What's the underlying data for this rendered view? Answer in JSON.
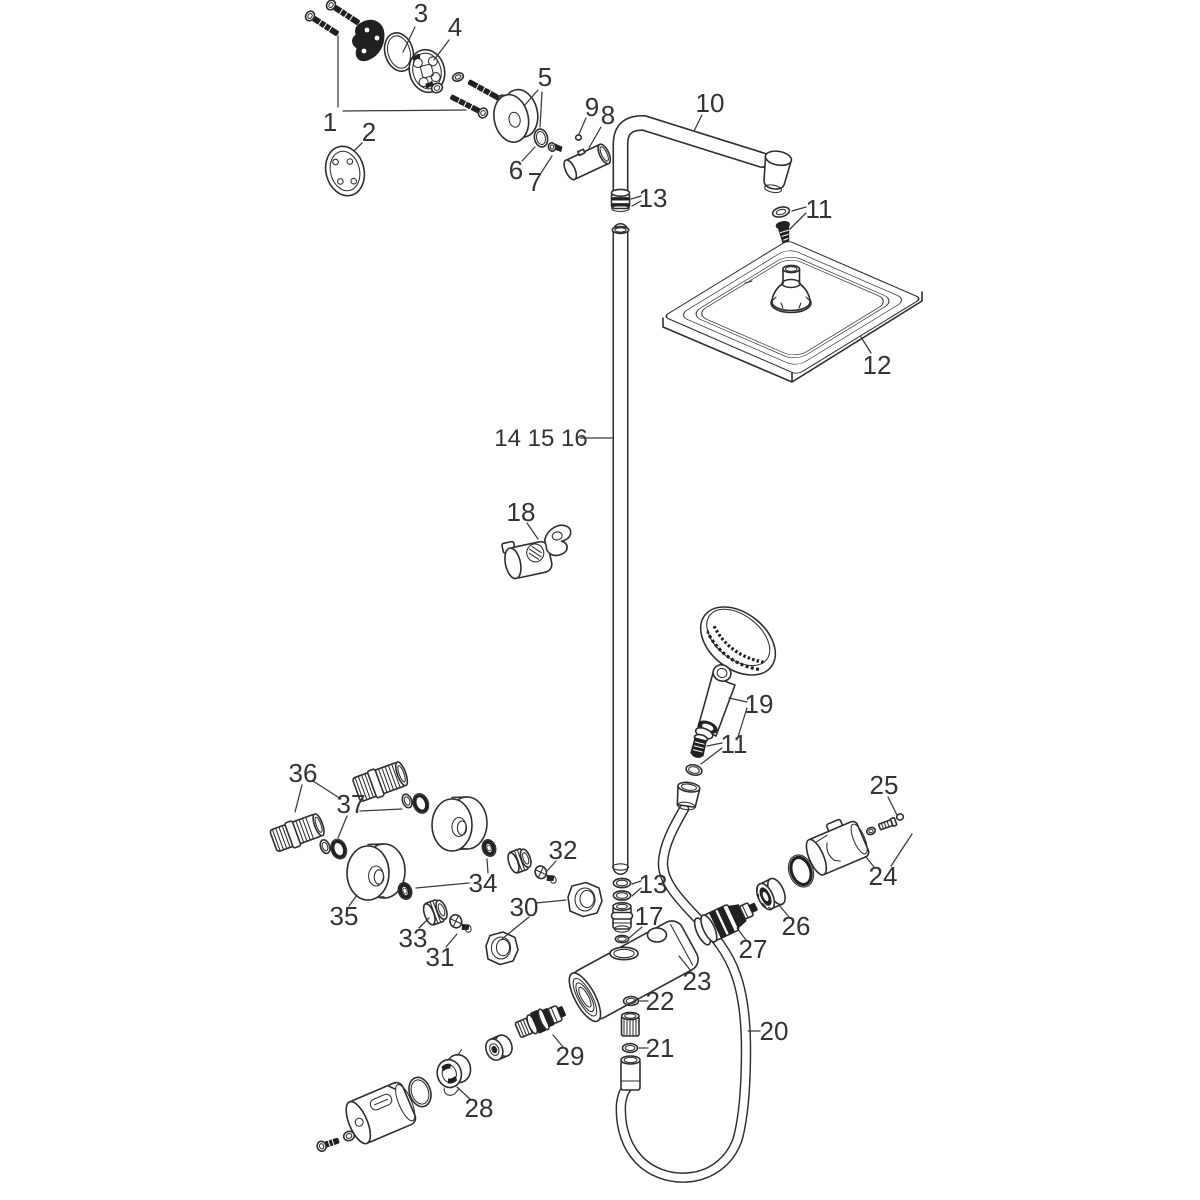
{
  "diagram": {
    "background": "#ffffff",
    "line_color": "#2e2e2e",
    "label_color": "#333333",
    "label_font_size": 26
  },
  "labels": [
    {
      "id": "3",
      "text": "3",
      "x": 421,
      "y": 22,
      "leaders": [
        [
          [
            415,
            27
          ],
          [
            403,
            52
          ]
        ]
      ]
    },
    {
      "id": "4",
      "text": "4",
      "x": 455,
      "y": 36,
      "leaders": [
        [
          [
            449,
            40
          ],
          [
            434,
            60
          ]
        ]
      ]
    },
    {
      "id": "1",
      "text": "1",
      "x": 330,
      "y": 131,
      "leaders": [
        [
          [
            338,
            107
          ],
          [
            338,
            36
          ]
        ],
        [
          [
            343,
            111
          ],
          [
            466,
            110
          ]
        ]
      ]
    },
    {
      "id": "2",
      "text": "2",
      "x": 369,
      "y": 141,
      "leaders": [
        [
          [
            362,
            143
          ],
          [
            354,
            151
          ]
        ]
      ]
    },
    {
      "id": "5",
      "text": "5",
      "x": 545,
      "y": 86,
      "leaders": [
        [
          [
            538,
            90
          ],
          [
            524,
            106
          ]
        ],
        [
          [
            542,
            92
          ],
          [
            540,
            127
          ]
        ]
      ]
    },
    {
      "id": "6",
      "text": "6",
      "x": 516,
      "y": 179,
      "leaders": [
        [
          [
            522,
            161
          ],
          [
            535,
            147
          ]
        ]
      ]
    },
    {
      "id": "7",
      "text": "7",
      "x": 535,
      "y": 191,
      "leaders": [
        [
          [
            541,
            173
          ],
          [
            552,
            156
          ]
        ]
      ]
    },
    {
      "id": "8",
      "text": "8",
      "x": 608,
      "y": 124,
      "leaders": [
        [
          [
            601,
            127
          ],
          [
            589,
            148
          ]
        ]
      ]
    },
    {
      "id": "9",
      "text": "9",
      "x": 592,
      "y": 116,
      "leaders": [
        [
          [
            586,
            118
          ],
          [
            579,
            134
          ]
        ]
      ]
    },
    {
      "id": "10",
      "text": "10",
      "x": 710,
      "y": 112,
      "leaders": [
        [
          [
            702,
            115
          ],
          [
            694,
            131
          ]
        ]
      ]
    },
    {
      "id": "11-top",
      "text": "11",
      "x": 819,
      "y": 218,
      "leaders": [
        [
          [
            806,
            207
          ],
          [
            792,
            211
          ]
        ],
        [
          [
            806,
            213
          ],
          [
            790,
            229
          ]
        ]
      ]
    },
    {
      "id": "12",
      "text": "12",
      "x": 877,
      "y": 374,
      "leaders": [
        [
          [
            871,
            353
          ],
          [
            861,
            337
          ]
        ]
      ]
    },
    {
      "id": "13-top",
      "text": "13",
      "x": 653,
      "y": 207,
      "leaders": [
        [
          [
            641,
            196
          ],
          [
            631,
            199
          ]
        ],
        [
          [
            641,
            201
          ],
          [
            632,
            206
          ]
        ]
      ]
    },
    {
      "id": "14-15-16",
      "text": "14 15 16",
      "x": 541,
      "y": 446,
      "size": 24,
      "leaders": [
        [
          [
            580,
            438
          ],
          [
            612,
            438
          ]
        ]
      ]
    },
    {
      "id": "18",
      "text": "18",
      "x": 521,
      "y": 521,
      "leaders": [
        [
          [
            527,
            523
          ],
          [
            538,
            539
          ]
        ]
      ]
    },
    {
      "id": "19",
      "text": "19",
      "x": 759,
      "y": 713,
      "leaders": [
        [
          [
            747,
            702
          ],
          [
            729,
            698
          ]
        ],
        [
          [
            747,
            708
          ],
          [
            737,
            740
          ]
        ]
      ]
    },
    {
      "id": "11-mid",
      "text": "11",
      "x": 734,
      "y": 753,
      "leaders": [
        [
          [
            722,
            743
          ],
          [
            707,
            746
          ]
        ],
        [
          [
            722,
            748
          ],
          [
            701,
            764
          ]
        ]
      ]
    },
    {
      "id": "20",
      "text": "20",
      "x": 774,
      "y": 1040,
      "leaders": [
        [
          [
            760,
            1031
          ],
          [
            748,
            1031
          ]
        ]
      ]
    },
    {
      "id": "25",
      "text": "25",
      "x": 884,
      "y": 794,
      "leaders": [
        [
          [
            888,
            797
          ],
          [
            897,
            815
          ]
        ]
      ]
    },
    {
      "id": "24",
      "text": "24",
      "x": 883,
      "y": 885,
      "leaders": [
        [
          [
            874,
            867
          ],
          [
            866,
            857
          ]
        ],
        [
          [
            891,
            866
          ],
          [
            912,
            834
          ]
        ]
      ]
    },
    {
      "id": "26",
      "text": "26",
      "x": 796,
      "y": 935,
      "leaders": [
        [
          [
            789,
            917
          ],
          [
            779,
            905
          ]
        ]
      ]
    },
    {
      "id": "27",
      "text": "27",
      "x": 753,
      "y": 958,
      "leaders": [
        [
          [
            746,
            940
          ],
          [
            737,
            928
          ]
        ]
      ]
    },
    {
      "id": "23",
      "text": "23",
      "x": 697,
      "y": 990,
      "leaders": [
        [
          [
            691,
            971
          ],
          [
            679,
            956
          ]
        ]
      ]
    },
    {
      "id": "13-bottom",
      "text": "13",
      "x": 653,
      "y": 893,
      "leaders": [
        [
          [
            641,
            881
          ],
          [
            632,
            884
          ]
        ],
        [
          [
            641,
            888
          ],
          [
            632,
            896
          ]
        ]
      ]
    },
    {
      "id": "17",
      "text": "17",
      "x": 649,
      "y": 925,
      "leaders": [
        [
          [
            642,
            927
          ],
          [
            629,
            938
          ]
        ]
      ]
    },
    {
      "id": "22",
      "text": "22",
      "x": 660,
      "y": 1010,
      "leaders": [
        [
          [
            648,
            1001
          ],
          [
            640,
            1001
          ]
        ]
      ]
    },
    {
      "id": "21",
      "text": "21",
      "x": 660,
      "y": 1057,
      "leaders": [
        [
          [
            648,
            1048
          ],
          [
            639,
            1048
          ]
        ]
      ]
    },
    {
      "id": "29",
      "text": "29",
      "x": 570,
      "y": 1065,
      "leaders": [
        [
          [
            563,
            1047
          ],
          [
            553,
            1035
          ]
        ]
      ]
    },
    {
      "id": "28",
      "text": "28",
      "x": 479,
      "y": 1117,
      "leaders": [
        [
          [
            471,
            1100
          ],
          [
            457,
            1087
          ]
        ]
      ]
    },
    {
      "id": "30",
      "text": "30",
      "x": 524,
      "y": 916,
      "leaders": [
        [
          [
            536,
            903
          ],
          [
            566,
            900
          ]
        ],
        [
          [
            529,
            917
          ],
          [
            502,
            939
          ]
        ]
      ]
    },
    {
      "id": "32",
      "text": "32",
      "x": 563,
      "y": 859,
      "leaders": [
        [
          [
            556,
            861
          ],
          [
            547,
            871
          ]
        ]
      ]
    },
    {
      "id": "33",
      "text": "33",
      "x": 413,
      "y": 947,
      "leaders": [
        [
          [
            419,
            928
          ],
          [
            429,
            918
          ]
        ]
      ]
    },
    {
      "id": "31",
      "text": "31",
      "x": 440,
      "y": 966,
      "leaders": [
        [
          [
            446,
            947
          ],
          [
            457,
            934
          ]
        ]
      ]
    },
    {
      "id": "34",
      "text": "34",
      "x": 483,
      "y": 892,
      "leaders": [
        [
          [
            488,
            873
          ],
          [
            487,
            859
          ]
        ],
        [
          [
            469,
            883
          ],
          [
            416,
            888
          ]
        ]
      ]
    },
    {
      "id": "35",
      "text": "35",
      "x": 344,
      "y": 925,
      "leaders": [
        [
          [
            349,
            906
          ],
          [
            357,
            895
          ]
        ]
      ]
    },
    {
      "id": "36",
      "text": "36",
      "x": 303,
      "y": 782,
      "leaders": [
        [
          [
            302,
            785
          ],
          [
            295,
            812
          ]
        ],
        [
          [
            313,
            781
          ],
          [
            341,
            799
          ]
        ]
      ]
    },
    {
      "id": "37",
      "text": "37",
      "x": 351,
      "y": 813,
      "leaders": [
        [
          [
            347,
            816
          ],
          [
            338,
            838
          ]
        ],
        [
          [
            360,
            811
          ],
          [
            402,
            809
          ]
        ]
      ]
    }
  ]
}
